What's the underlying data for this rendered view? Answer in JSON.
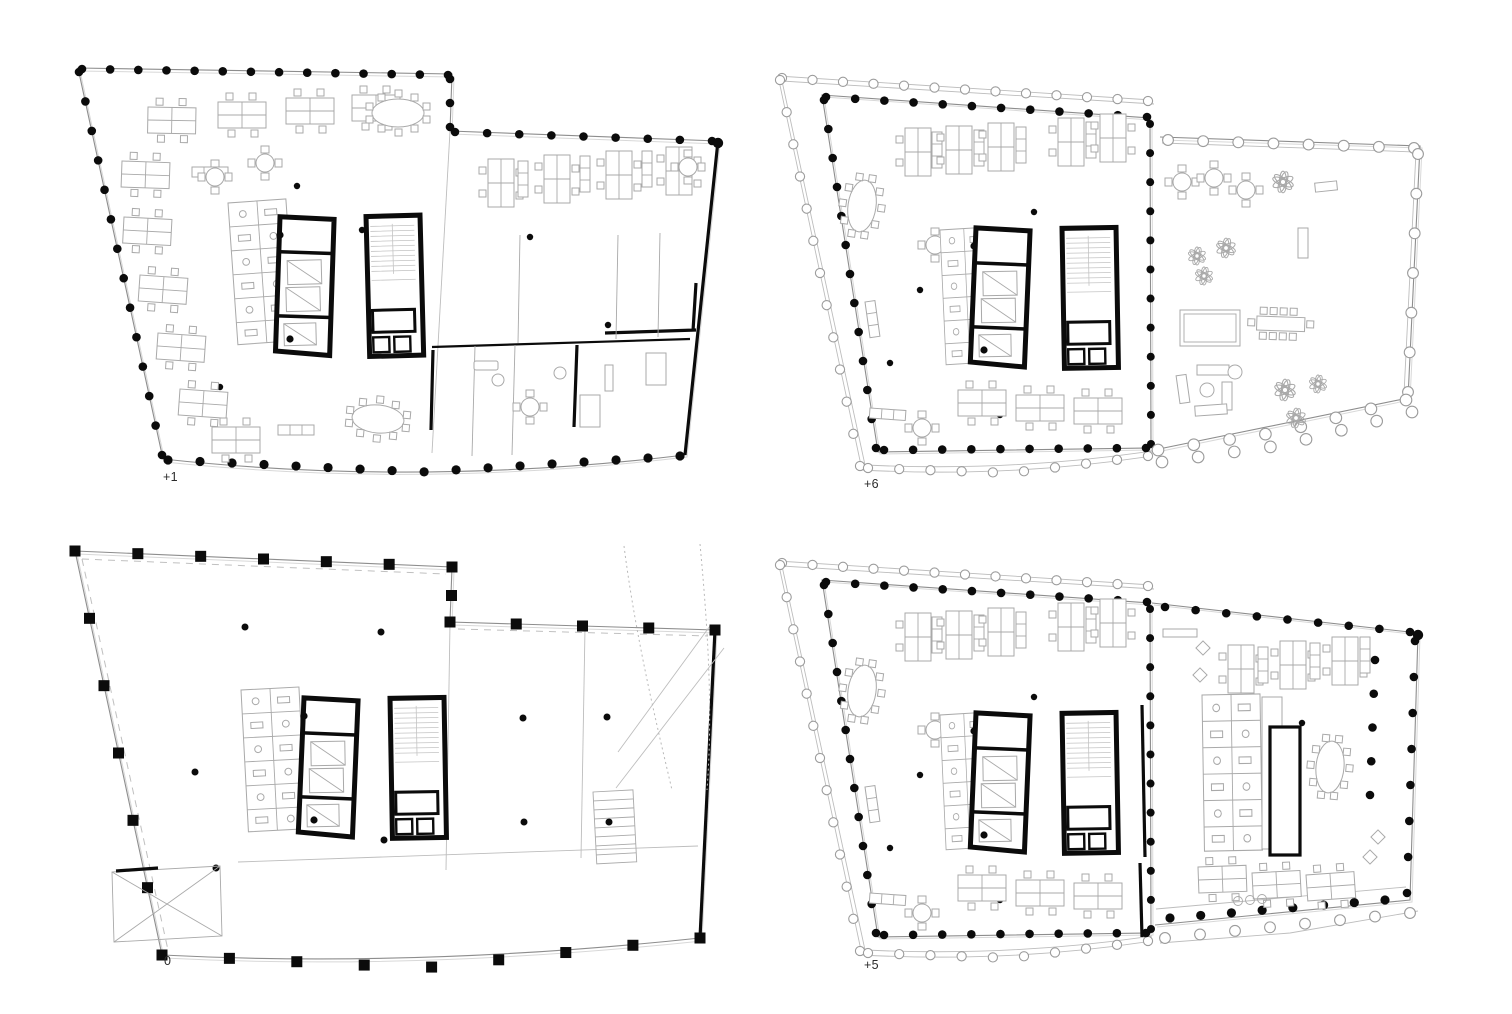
{
  "figure": {
    "type": "architectural-floor-plan-sheet",
    "layout": "2x2-grid",
    "plans": [
      {
        "id": "plus1",
        "label": "+1",
        "position": "top-left"
      },
      {
        "id": "plus6",
        "label": "+6",
        "position": "top-right"
      },
      {
        "id": "zero",
        "label": "0",
        "position": "bottom-left"
      },
      {
        "id": "plus5",
        "label": "+5",
        "position": "bottom-right"
      }
    ],
    "colors": {
      "ink": "#0b0b0b",
      "outline": "#8d8d8d",
      "furniture": "#a9a9a9",
      "light": "#bdbdbd",
      "paper": "#ffffff"
    }
  }
}
